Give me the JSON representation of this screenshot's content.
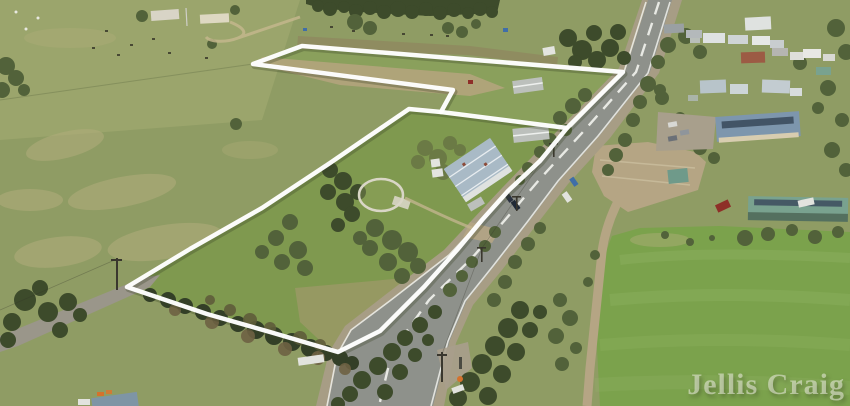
{
  "watermark": {
    "text": "Jellis Craig"
  },
  "colors": {
    "base_field": "#8f9c64",
    "field_top_left": "#9ba56c",
    "pale_patch": "#b2ad7c",
    "parcel_upper": "#8aa05c",
    "parcel_lower": "#7f994f",
    "oval_green": "#7ba24c",
    "mow_stripe": "#92b566",
    "dirt": "#b5a584",
    "dirt_strip": "#b2a47c",
    "plough_brown": "#8f875f",
    "south_dry_grass": "#a59a6f",
    "road_asphalt": "#8e918b",
    "road_shoulder": "#a79d85",
    "lane_gray": "#9a968a",
    "gravel_parking": "#a89f8c",
    "tree_dark": "#3d4b2b",
    "tree_mid": "#52623a",
    "tree_olive": "#6b7a45",
    "hedge_dark": "#333f27",
    "scrub_brown": "#6e6243",
    "scrub_olive": "#5f5d3a",
    "boundary_white": "#ffffff",
    "boundary_shadow": "rgba(55,65,35,0.3)",
    "marking_white": "#f0f1ec",
    "roof_homestead": "#a9bac6",
    "roof_light": "#dfe2e0",
    "roof_gray": "#bcc0bc",
    "roof_red": "#9c5b44",
    "roof_blue": "#7d96ad",
    "roof_teal": "#79a28f",
    "pavilion_front": "#54705f",
    "solar_panel": "#3c4c5e",
    "wall_cream": "#d8cdb0",
    "ruin_white": "#d8d4c6",
    "shed_cream": "#ded8c2",
    "garden_ring": "#d9d6c6",
    "caravan_white": "#e3e4df",
    "car_red": "#8e2f28",
    "car_blue": "#3f6ea8",
    "car_dark": "#2b3240",
    "vehicle_white": "#e2e3de",
    "hi_vis_orange": "#d4722c",
    "livestock_dark": "#3a392b",
    "sheep_white": "#e8e8e0",
    "pole_dark": "#3a372e",
    "watermark_fill": "rgba(238,239,228,0.55)"
  }
}
